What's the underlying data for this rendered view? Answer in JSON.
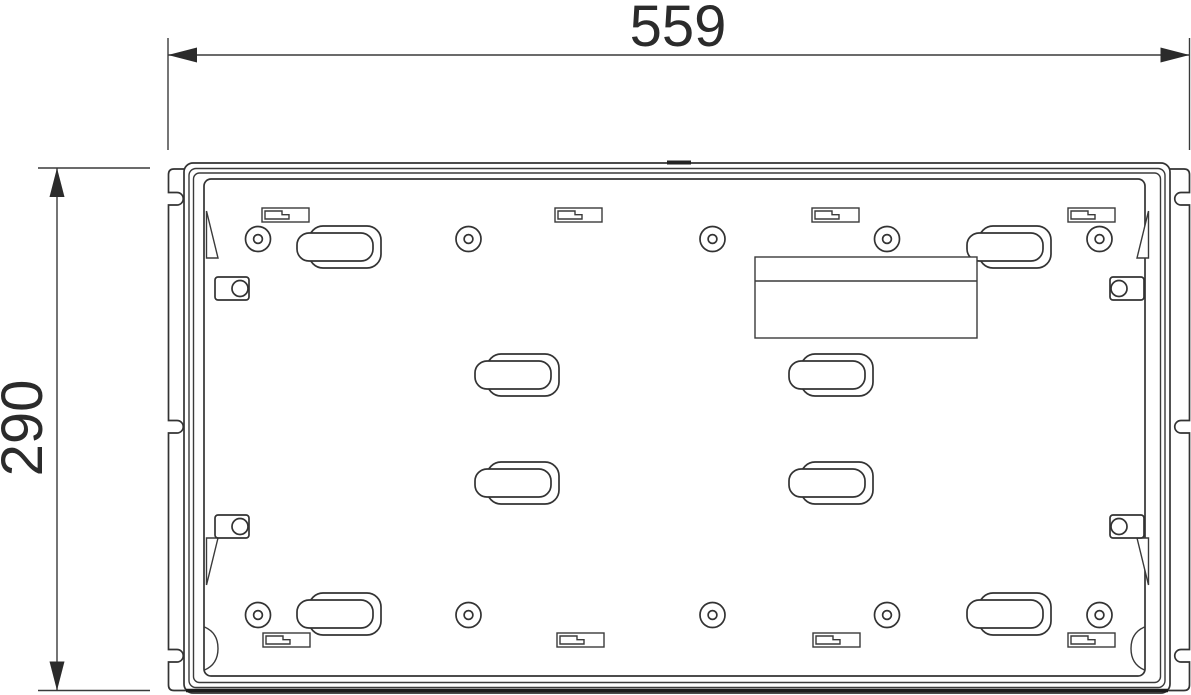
{
  "drawing": {
    "type": "technical-dimension-drawing",
    "subject": "rear mounting plate",
    "width_dimension_label": "559",
    "height_dimension_label": "290"
  },
  "colors": {
    "line": "#333333",
    "dimension_text": "#2b2b2b",
    "background": "#ffffff"
  }
}
